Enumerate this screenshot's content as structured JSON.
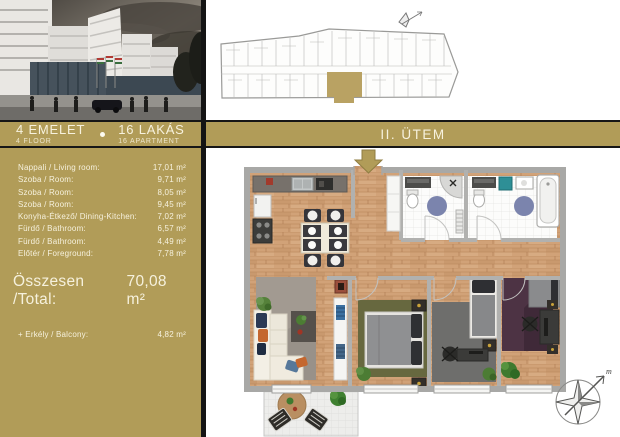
{
  "header": {
    "floor": {
      "primary": "4 EMELET",
      "secondary": "4  FLOOR"
    },
    "apartments": {
      "primary": "16 LAKÁS",
      "secondary": "16  APARTMENT"
    },
    "phase": "II. ÜTEM"
  },
  "room_table": {
    "rows": [
      {
        "label": "Nappali / Living room:",
        "value": "17,01 m²"
      },
      {
        "label": "Szoba / Room:",
        "value": "9,71 m²"
      },
      {
        "label": "Szoba / Room:",
        "value": "8,05 m²"
      },
      {
        "label": "Szoba / Room:",
        "value": "9,45 m²"
      },
      {
        "label": "Konyha-Étkező/ Dining-Kitchen:",
        "value": "7,02 m²"
      },
      {
        "label": "Fürdő / Bathroom:",
        "value": "6,57 m²"
      },
      {
        "label": "Fürdő / Bathroom:",
        "value": "4,49 m²"
      },
      {
        "label": "Előtér / Foreground:",
        "value": "7,78 m²"
      }
    ],
    "total": {
      "label": "Összesen /Total:",
      "value": "70,08 m²"
    },
    "balcony": {
      "label": "+ Erkély / Balcony:",
      "value": "4,82 m²"
    }
  },
  "floor_plan": {
    "compass_label": "m"
  },
  "icons": {
    "entrance_arrow": "down-arrow",
    "compass": "compass-rose",
    "separator": "dot"
  },
  "colors": {
    "gold": "#b19c58",
    "highlight_unit": "#b9a263",
    "wood_floor": "#d1a278",
    "bath_rug_blue": "#7b84ad",
    "living_rug": "#989189",
    "master_rug": "#67683f",
    "room3_rug": "#6e6e6c",
    "room4_rug": "#4d3344"
  }
}
